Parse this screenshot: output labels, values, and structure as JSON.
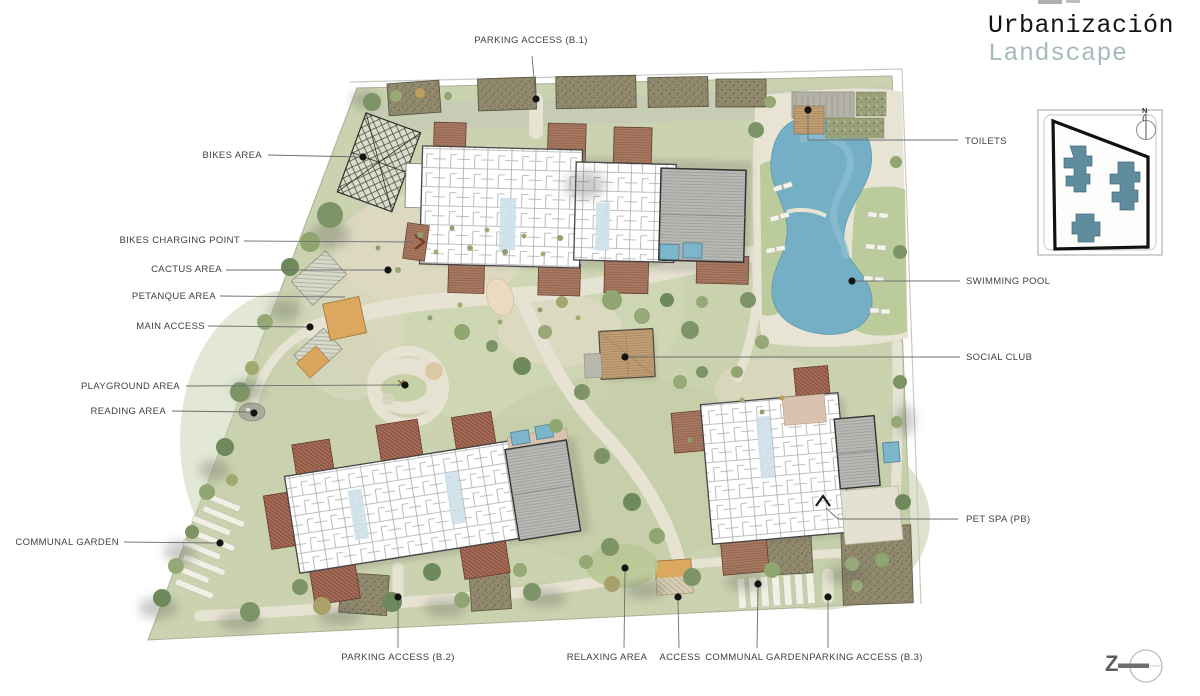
{
  "title": {
    "line1": "Urbanización",
    "line2": "Landscape"
  },
  "callouts": {
    "parking_b1": {
      "label": "PARKING ACCESS (B.1)"
    },
    "bikes_area": {
      "label": "BIKES AREA"
    },
    "bikes_charging": {
      "label": "BIKES CHARGING POINT"
    },
    "cactus": {
      "label": "CACTUS AREA"
    },
    "petanque": {
      "label": "PETANQUE AREA"
    },
    "main_access": {
      "label": "MAIN ACCESS"
    },
    "playground": {
      "label": "PLAYGROUND AREA"
    },
    "reading": {
      "label": "READING AREA"
    },
    "communal_left": {
      "label": "COMMUNAL GARDEN"
    },
    "parking_b2": {
      "label": "PARKING ACCESS (B.2)"
    },
    "relaxing": {
      "label": "RELAXING AREA"
    },
    "access": {
      "label": "ACCESS"
    },
    "communal_bottom": {
      "label": "COMMUNAL GARDEN"
    },
    "parking_b3": {
      "label": "PARKING ACCESS (B.3)"
    },
    "toilets": {
      "label": "TOILETS"
    },
    "pool": {
      "label": "SWIMMING POOL"
    },
    "social": {
      "label": "SOCIAL CLUB"
    },
    "petspa": {
      "label": "PET SPA (PB)"
    }
  },
  "keyplan": {
    "north": "N"
  },
  "logo": {
    "mark": "Z"
  },
  "colors": {
    "ground": "#cbd2b0",
    "path": "#e7e3d2",
    "pool": "#74afc6",
    "keyplan_building": "#5f8d9d",
    "roof_red": "#a76c57",
    "accent_orange": "#dca75f",
    "title_secondary": "#a6b9bc"
  }
}
